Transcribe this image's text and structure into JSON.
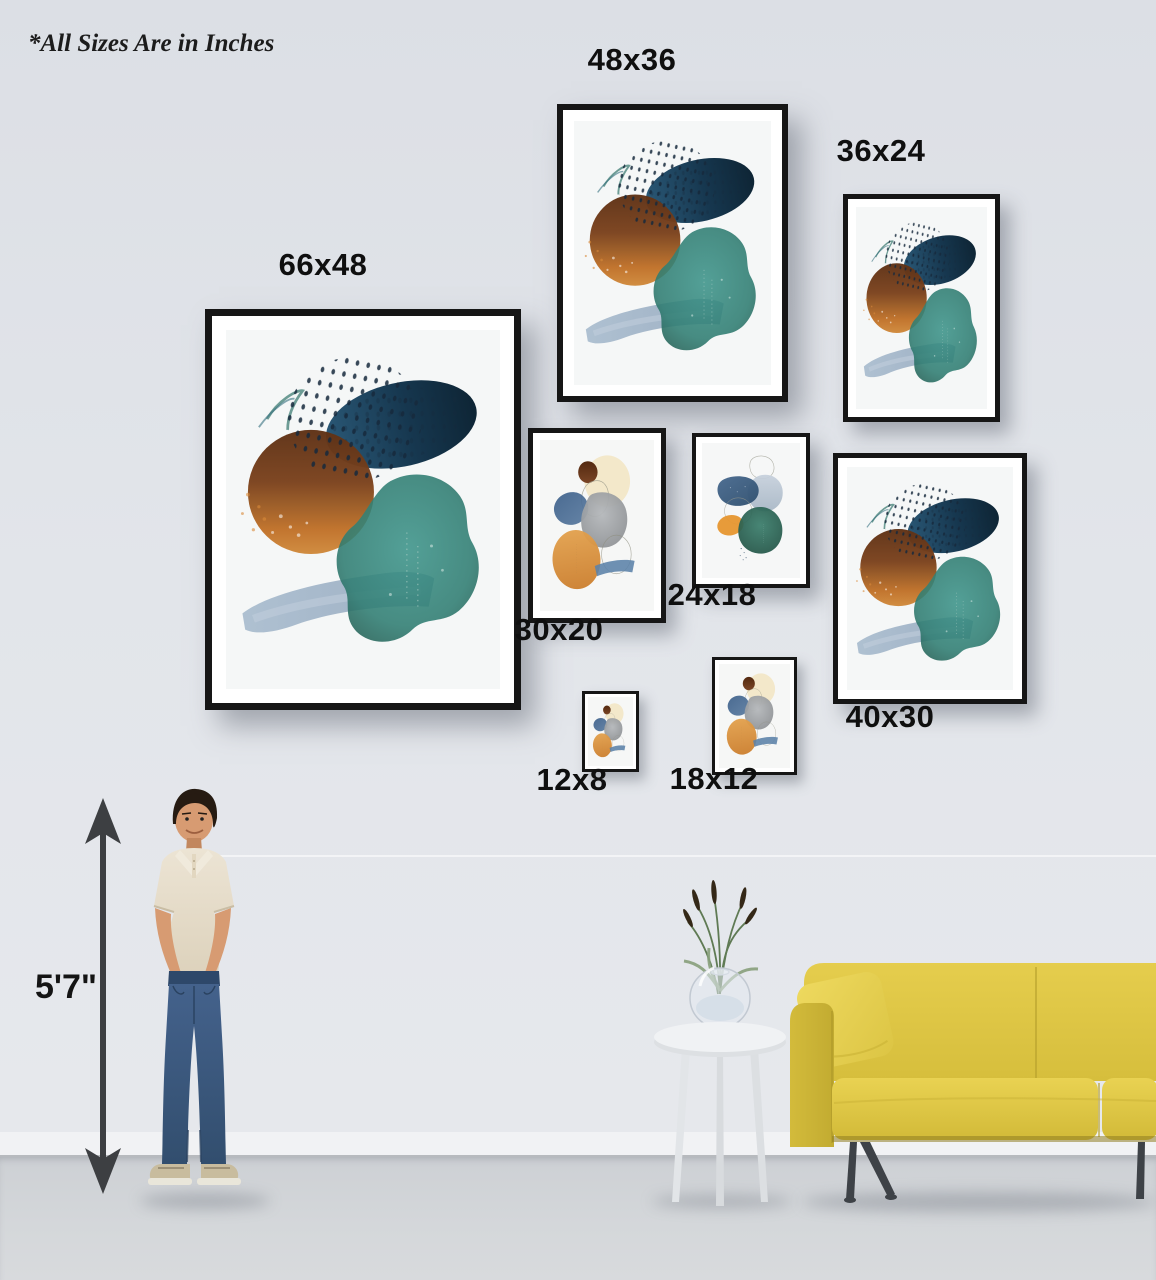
{
  "note": "*All Sizes Are in Inches",
  "height_marker": {
    "label": "5'7\""
  },
  "frames": [
    {
      "size": "66x48",
      "artwork": "teal-rust-abstract",
      "label_position": "above"
    },
    {
      "size": "48x36",
      "artwork": "teal-rust-abstract",
      "label_position": "above"
    },
    {
      "size": "36x24",
      "artwork": "teal-rust-abstract",
      "label_position": "above"
    },
    {
      "size": "30x20",
      "artwork": "gray-orange-abstract",
      "label_position": "below"
    },
    {
      "size": "24x18",
      "artwork": "blue-teal-abstract",
      "label_position": "below"
    },
    {
      "size": "40x30",
      "artwork": "teal-rust-abstract",
      "label_position": "below"
    },
    {
      "size": "12x8",
      "artwork": "gray-orange-abstract",
      "label_position": "below"
    },
    {
      "size": "18x12",
      "artwork": "gray-orange-abstract",
      "label_position": "below"
    }
  ],
  "colors": {
    "wall": "#e2e5ea",
    "floor": "#d2d5d8",
    "baseboard": "#f1f2f4",
    "frame_border": "#161616",
    "label_text": "#0f0f0f",
    "arrow": "#3d3f42",
    "sofa_yellow": "#dcc441",
    "art_navy": "#1c3d56",
    "art_rust": "#8a4a22",
    "art_orange": "#cc7e31",
    "art_teal": "#2f7d72",
    "art_bluegray": "#93a9c0"
  }
}
